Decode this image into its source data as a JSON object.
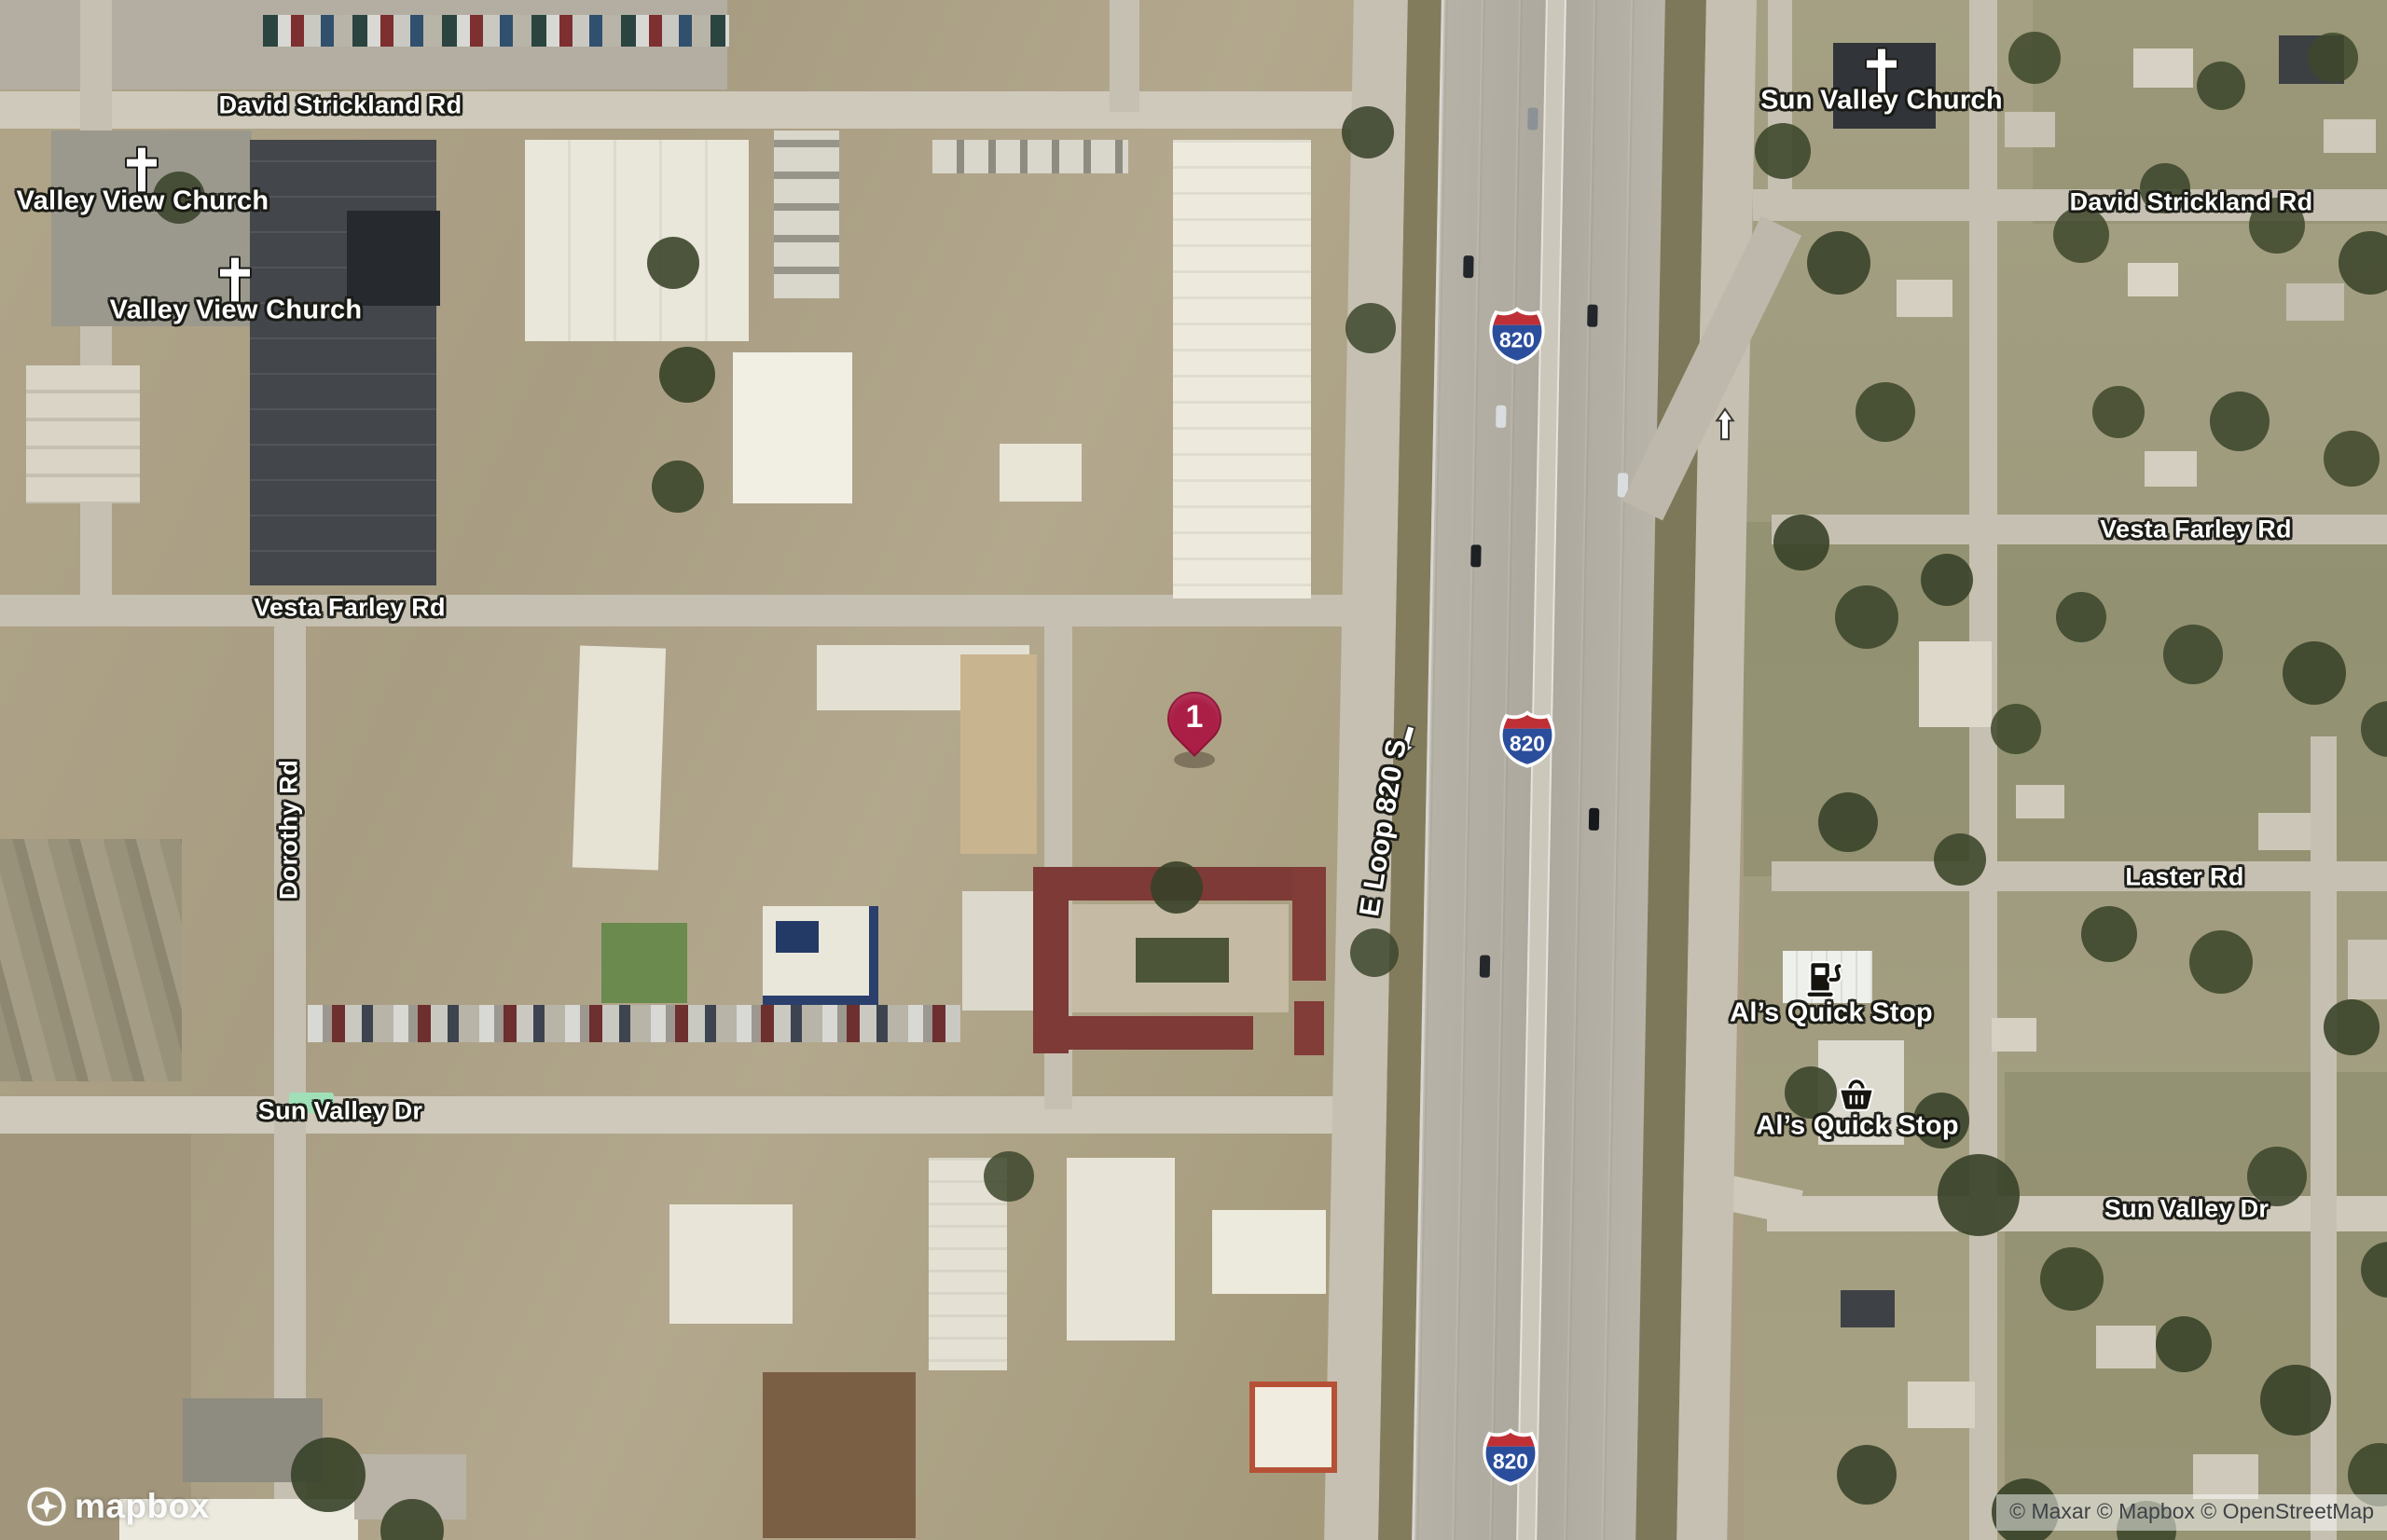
{
  "map": {
    "road_labels": [
      {
        "text": "David Strickland Rd",
        "orientation": "horizontal"
      },
      {
        "text": "Vesta Farley Rd",
        "orientation": "horizontal"
      },
      {
        "text": "Dorothy Rd",
        "orientation": "vertical"
      },
      {
        "text": "Sun Valley Dr",
        "orientation": "horizontal"
      },
      {
        "text": "E Loop 820 S",
        "orientation": "vertical"
      },
      {
        "text": "David Strickland Rd",
        "orientation": "horizontal"
      },
      {
        "text": "Vesta Farley Rd",
        "orientation": "horizontal"
      },
      {
        "text": "Laster Rd",
        "orientation": "horizontal"
      },
      {
        "text": "Sun Valley Dr",
        "orientation": "horizontal"
      }
    ],
    "poi_labels": [
      {
        "text": "Valley View Church",
        "icon": "church-cross-icon"
      },
      {
        "text": "Valley View Church",
        "icon": "church-cross-icon"
      },
      {
        "text": "Sun Valley Church",
        "icon": "church-cross-icon"
      },
      {
        "text": "Al’s Quick Stop",
        "icon": "fuel-pump-icon"
      },
      {
        "text": "Al’s Quick Stop",
        "icon": "shopping-basket-icon"
      }
    ],
    "highway_shields": [
      {
        "label": "820"
      },
      {
        "label": "820"
      },
      {
        "label": "820"
      }
    ],
    "marker": {
      "number": "1",
      "color": "#ab1e46"
    },
    "arrows": [
      {
        "name": "one-way-arrow",
        "direction": "down"
      },
      {
        "name": "one-way-arrow",
        "direction": "up"
      }
    ],
    "logo": {
      "text": "mapbox"
    },
    "attribution": {
      "text": "© Maxar © Mapbox © OpenStreetMap"
    },
    "colors": {
      "marker": "#ab1e46",
      "shield_red": "#bf3036",
      "shield_blue": "#2b4e9c",
      "label_color": "#ffffff",
      "label_halo": "#19190f",
      "highlighted_building": "#7d3a36"
    }
  }
}
